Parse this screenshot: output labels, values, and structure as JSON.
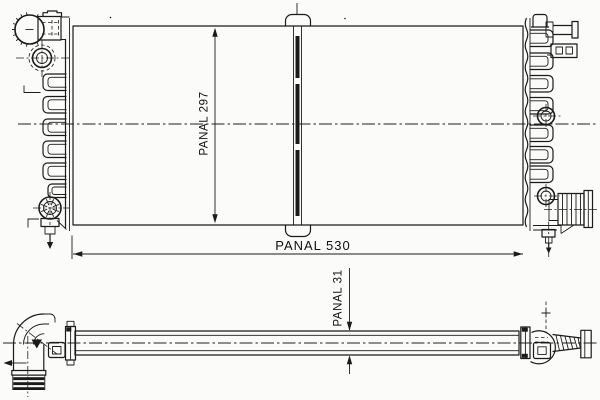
{
  "drawing": {
    "background_color": "#fbfbf9",
    "line_color": "#1b1b1b",
    "type": "radiator-technical-drawing",
    "dimensions": {
      "core_height": {
        "label": "PANAL 297",
        "orientation": "vertical"
      },
      "core_width": {
        "label": "PANAL 530",
        "orientation": "horizontal"
      },
      "core_depth": {
        "label": "PANAL 31",
        "orientation": "vertical"
      }
    }
  }
}
